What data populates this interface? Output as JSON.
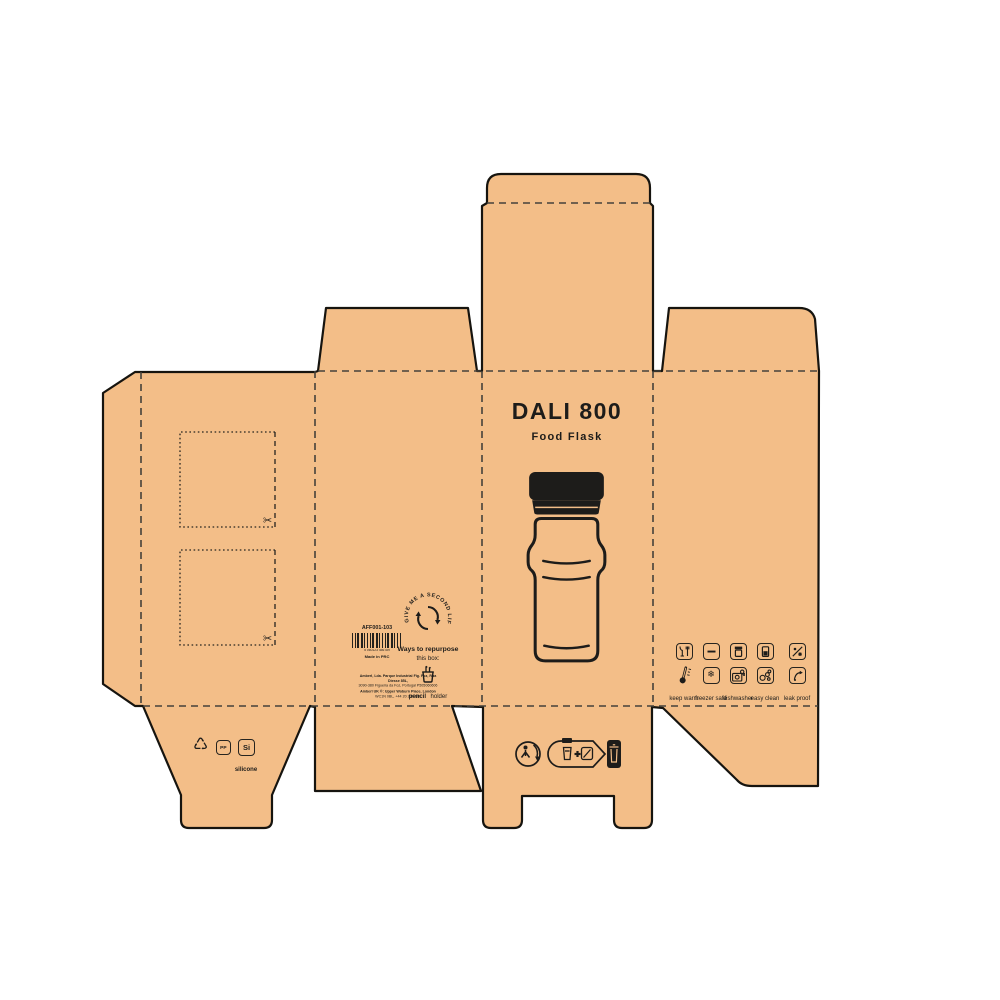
{
  "artboard": {
    "background": "#ffffff"
  },
  "colors": {
    "kraft": "#F3BE88",
    "outline": "#16140F",
    "fold": "#45413A",
    "ink": "#1D1C1A"
  },
  "front_panel": {
    "title": "DALI 800",
    "subtitle": "Food Flask"
  },
  "info_panel": {
    "product_code": "AFF001-103",
    "barcode_digits": "5 060123 456789",
    "origin": "Made in PRC",
    "badge_text": "GIVE ME A SECOND LIFE",
    "repurpose_heading": "Ways to repurpose",
    "repurpose_subheading": "this box:",
    "repurpose_item_line1": "pencil",
    "repurpose_item_line2": "holder",
    "address_line1": "Amberl, Lda. Parque Industrial Fig. Foz, Rua Diesse 85L,",
    "address_line2": "3090-380 Figueira da Foz, Portugal P505060606",
    "address_line3": "Amberl UK ®: Upper Woburn Place, London",
    "address_line4": "WC1N 0BL, +44 20 236 180"
  },
  "care_panel": {
    "icons_row1": [
      "food-safe",
      "capacity",
      "hot-content",
      "cold-content",
      "hot-cold"
    ],
    "icons_row2": [
      "max-temperature",
      "freezer-safe",
      "dishwasher-safe",
      "easy-clean",
      "leak-proof"
    ],
    "captions": [
      "keep warm",
      "freezer safe",
      "dishwasher",
      "easy clean",
      "leak proof"
    ]
  },
  "materials_flap": {
    "pp_label": "PP",
    "si_label": "Si",
    "si_caption": "silicone"
  },
  "glyphs": {
    "snowflake": "❄",
    "recycle": "♺",
    "scissors": "✂"
  }
}
